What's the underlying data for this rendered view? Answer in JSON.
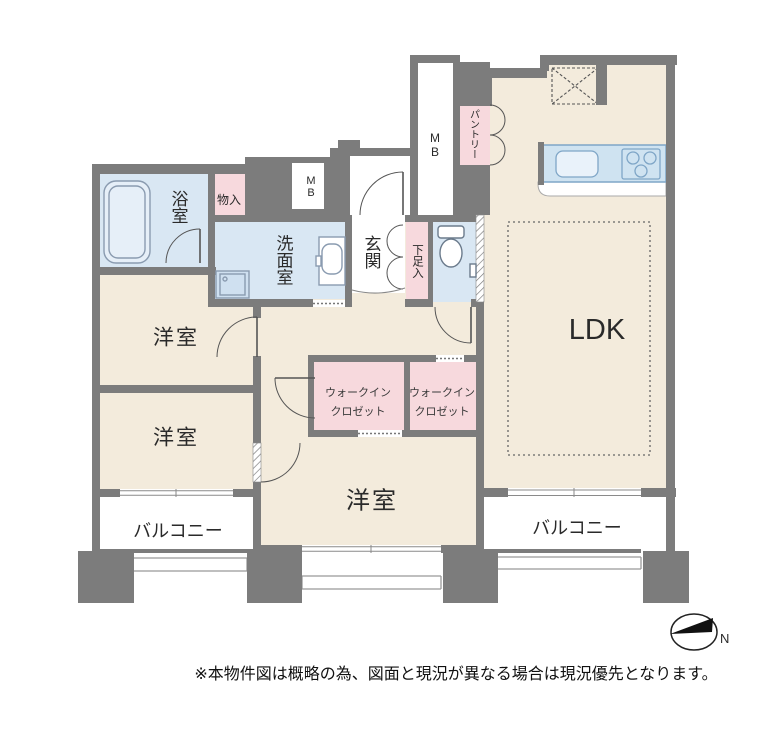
{
  "rooms": {
    "bathroom": "浴室",
    "storage": "物入",
    "meter_box": "MB",
    "pantry": "パントリー",
    "washroom": "洗面室",
    "entrance": "玄関",
    "shoe_cabinet": "下足入",
    "ldk": "LDK",
    "bedroom": "洋室",
    "wic_line1": "ウォークイン",
    "wic_line2": "クロゼット",
    "balcony": "バルコニー"
  },
  "compass": {
    "north": "N"
  },
  "footer": {
    "note": "※本物件図は概略の為、図面と現況が異なる場合は現況優先となります。"
  },
  "colors": {
    "wall": "#7c7c7c",
    "floor": "#f3ebdc",
    "wet": "#d9e7f3",
    "closet": "#f7d9dd",
    "white": "#ffffff",
    "counter": "#cfe3f1",
    "counter_border": "#7fa6c7",
    "sink_fill": "#e9f2fa",
    "fixture": "#8a9bb0",
    "line": "#555555",
    "text": "#2a2a2a",
    "note_text": "#111111"
  }
}
